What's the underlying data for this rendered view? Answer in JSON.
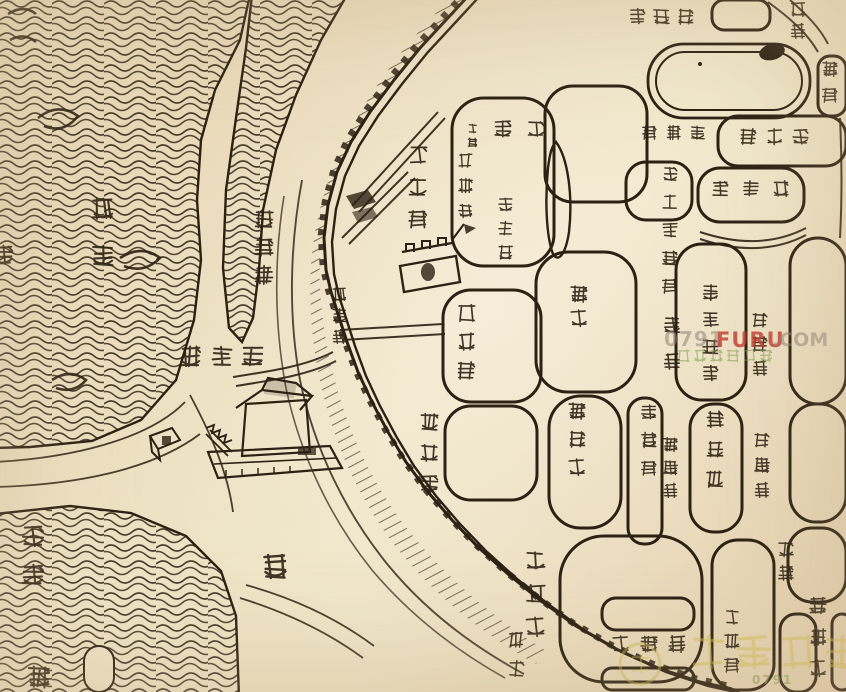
{
  "canvas": {
    "width": 846,
    "height": 692,
    "paper_color": "#efe5c8",
    "ink_color": "#2c2113"
  },
  "map": {
    "type": "historical-chinese-city-map",
    "river_name": "章江",
    "landmark_sketches": [
      "滕王閣樓閣圖",
      "章江門城樓",
      "城牆雉堞",
      "章江水紋",
      "新洲沙洲",
      "護城濠",
      "東湖水池"
    ],
    "labels": [
      {
        "name": "zhangjiang-river",
        "reading": "章江",
        "chars": [
          "章",
          "江"
        ],
        "x": 90,
        "y": 196,
        "dy": 47,
        "size": 26,
        "orientation": "vertical"
      },
      {
        "name": "wuqiaoze",
        "reading": "五橋澤",
        "chars": [
          "五",
          "橋",
          "澤"
        ],
        "x": 253,
        "y": 208,
        "dy": 28,
        "size": 22,
        "orientation": "vertical"
      },
      {
        "name": "zhangjiangmen-gate",
        "reading": "章江門",
        "chars": [
          "章",
          "江",
          "門"
        ],
        "x": 331,
        "y": 286,
        "dy": 21,
        "size": 17,
        "orientation": "vertical"
      },
      {
        "name": "zongmaoxiang",
        "reading": "棕帽巷",
        "chars": [
          "棕",
          "帽",
          "巷"
        ],
        "x": 407,
        "y": 144,
        "dy": 32,
        "size": 22,
        "orientation": "vertical"
      },
      {
        "name": "jiefeng",
        "reading": "接俸",
        "chars": [
          "俸",
          "接"
        ],
        "x": 493,
        "y": 119,
        "dx": 33,
        "size": 20,
        "orientation": "horizontal-rtl"
      },
      {
        "name": "heyi",
        "reading": "合邑",
        "chars": [
          "合",
          "邑"
        ],
        "x": 467,
        "y": 123,
        "dy": 14,
        "size": 11,
        "orientation": "vertical"
      },
      {
        "name": "pujicang",
        "reading": "普濟倉",
        "chars": [
          "普",
          "濟",
          "倉"
        ],
        "x": 457,
        "y": 152,
        "dy": 25,
        "size": 17,
        "orientation": "vertical"
      },
      {
        "name": "buzhengsi",
        "reading": "布政司",
        "chars": [
          "布",
          "政",
          "司"
        ],
        "x": 497,
        "y": 196,
        "dy": 24,
        "size": 17,
        "orientation": "vertical"
      },
      {
        "name": "dabeiyuan",
        "reading": "大悲院",
        "chars": [
          "院",
          "悲",
          "大"
        ],
        "x": 628,
        "y": 7,
        "dx": 24,
        "size": 19,
        "orientation": "horizontal-rtl"
      },
      {
        "name": "guangmen-partial",
        "reading": "廣門",
        "chars": [
          "廣",
          "門"
        ],
        "x": 789,
        "y": 0,
        "dy": 22,
        "size": 18,
        "orientation": "vertical"
      },
      {
        "name": "xixiang-partial",
        "reading": "西巷",
        "chars": [
          "西",
          "巷"
        ],
        "x": 821,
        "y": 60,
        "dy": 26,
        "size": 18,
        "orientation": "vertical"
      },
      {
        "name": "biaojiaxiang",
        "reading": "表家巷",
        "chars": [
          "巷",
          "家",
          "表"
        ],
        "x": 641,
        "y": 124,
        "dx": 24,
        "size": 17,
        "orientation": "horizontal-rtl"
      },
      {
        "name": "xinjianxian",
        "reading": "新建縣",
        "chars": [
          "縣",
          "建",
          "新"
        ],
        "x": 739,
        "y": 127,
        "dx": 26,
        "size": 19,
        "orientation": "horizontal-rtl"
      },
      {
        "name": "xuepujting",
        "reading": "學圃亭",
        "chars": [
          "亭",
          "圃",
          "學"
        ],
        "x": 711,
        "y": 179,
        "dx": 30,
        "size": 19,
        "orientation": "horizontal-rtl"
      },
      {
        "name": "sidaoqian-guanxiang",
        "reading": "四道前官巷",
        "chars": [
          "四",
          "道",
          "前",
          "官",
          "巷"
        ],
        "x": 661,
        "y": 165,
        "dy": 28,
        "size": 18,
        "orientation": "vertical"
      },
      {
        "name": "yimen",
        "reading": "儀門",
        "chars": [
          "儀",
          "門"
        ],
        "x": 662,
        "y": 315,
        "dy": 36,
        "size": 20,
        "orientation": "vertical"
      },
      {
        "name": "xijie",
        "reading": "西街",
        "chars": [
          "西",
          "街"
        ],
        "x": 569,
        "y": 284,
        "dy": 24,
        "size": 20,
        "orientation": "vertical"
      },
      {
        "name": "nanchangxian",
        "reading": "南昌縣",
        "chars": [
          "南",
          "昌",
          "縣"
        ],
        "x": 456,
        "y": 302,
        "dy": 29,
        "size": 21,
        "orientation": "vertical"
      },
      {
        "name": "xunfubuyuan",
        "reading": "巡撫部院",
        "chars": [
          "巡",
          "撫",
          "部",
          "院"
        ],
        "x": 701,
        "y": 283,
        "dy": 27,
        "size": 19,
        "orientation": "vertical"
      },
      {
        "name": "dongxianmen",
        "reading": "東縣門",
        "chars": [
          "東",
          "縣",
          "門"
        ],
        "x": 751,
        "y": 311,
        "dy": 24,
        "size": 18,
        "orientation": "vertical"
      },
      {
        "name": "xidajie",
        "reading": "西大街",
        "chars": [
          "西",
          "大",
          "街"
        ],
        "x": 567,
        "y": 401,
        "dy": 28,
        "size": 20,
        "orientation": "vertical"
      },
      {
        "name": "guguxiang",
        "reading": "古鼓巷",
        "chars": [
          "古",
          "鼓",
          "巷"
        ],
        "x": 640,
        "y": 403,
        "dy": 28,
        "size": 18,
        "orientation": "vertical"
      },
      {
        "name": "zongzhenfu",
        "reading": "總鎮府",
        "chars": [
          "總",
          "鎮",
          "府"
        ],
        "x": 705,
        "y": 409,
        "dy": 30,
        "size": 20,
        "orientation": "vertical"
      },
      {
        "name": "xiyuanmen",
        "reading": "西轅門",
        "chars": [
          "西",
          "轅",
          "門"
        ],
        "x": 662,
        "y": 436,
        "dy": 23,
        "size": 17,
        "orientation": "vertical"
      },
      {
        "name": "dongyuanmen",
        "reading": "東轅門",
        "chars": [
          "東",
          "轅",
          "門"
        ],
        "x": 753,
        "y": 431,
        "dy": 25,
        "size": 18,
        "orientation": "vertical"
      },
      {
        "name": "fenghuangpo",
        "reading": "鳳凰坡",
        "chars": [
          "鳳",
          "凰",
          "坡"
        ],
        "x": 419,
        "y": 411,
        "dy": 31,
        "size": 21,
        "orientation": "vertical"
      },
      {
        "name": "tengwangge",
        "reading": "滕王閣",
        "chars": [
          "閣",
          "王",
          "滕"
        ],
        "x": 178,
        "y": 344,
        "dx": 31,
        "size": 25,
        "orientation": "horizontal-rtl"
      },
      {
        "name": "qiaobujie",
        "reading": "翹步街",
        "chars": [
          "翹",
          "步",
          "街"
        ],
        "x": 524,
        "y": 549,
        "dy": 33,
        "size": 23,
        "orientation": "vertical"
      },
      {
        "name": "hao-moat",
        "reading": "濠",
        "chars": [
          "濠"
        ],
        "x": 260,
        "y": 551,
        "size": 30,
        "orientation": "vertical"
      },
      {
        "name": "xinzhou",
        "reading": "新洲",
        "chars": [
          "新",
          "洲"
        ],
        "x": 20,
        "y": 523,
        "dy": 39,
        "size": 26,
        "orientation": "vertical"
      },
      {
        "name": "xihe-partial",
        "reading": "西",
        "chars": [
          "西"
        ],
        "x": 26,
        "y": 664,
        "size": 26,
        "orientation": "vertical"
      },
      {
        "name": "left-edge-partial",
        "reading": "洲",
        "chars": [
          "洲"
        ],
        "x": -9,
        "y": 243,
        "size": 24,
        "orientation": "vertical"
      },
      {
        "name": "shetan",
        "reading": "社壇",
        "chars": [
          "社",
          "壇"
        ],
        "x": 507,
        "y": 630,
        "dy": 29,
        "size": 19,
        "orientation": "vertical"
      },
      {
        "name": "qipanjie",
        "reading": "棋盤街",
        "chars": [
          "街",
          "盤",
          "棋"
        ],
        "x": 611,
        "y": 634,
        "dx": 28,
        "size": 20,
        "orientation": "horizontal-rtl"
      },
      {
        "name": "hetongxiang",
        "reading": "合同巷",
        "chars": [
          "合",
          "同",
          "巷"
        ],
        "x": 723,
        "y": 608,
        "dy": 24,
        "size": 18,
        "orientation": "vertical"
      },
      {
        "name": "gaoqiao",
        "reading": "高橋",
        "chars": [
          "高",
          "橋"
        ],
        "x": 777,
        "y": 540,
        "dy": 24,
        "size": 18,
        "orientation": "vertical"
      },
      {
        "name": "cuihuajie",
        "reading": "翠花街",
        "chars": [
          "翠",
          "花",
          "街"
        ],
        "x": 808,
        "y": 596,
        "dy": 31,
        "size": 20,
        "orientation": "vertical"
      }
    ]
  },
  "watermarks": {
    "center": {
      "prefix": "0791",
      "brand": "FURU",
      "suffix": ".COM",
      "tagline": "南昌房屋装修",
      "brand_color": "#c23a2e",
      "text_color": "#8f857a",
      "tagline_color": "#7fa054"
    },
    "bottom": {
      "text": "佳园装饰",
      "small_text": "0791",
      "color": "#d2bf52",
      "small_color": "#8aa35c"
    }
  }
}
